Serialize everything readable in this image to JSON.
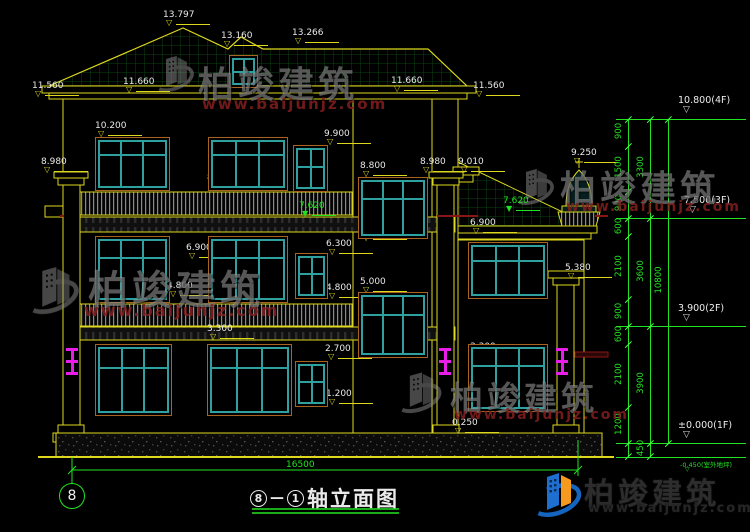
{
  "title": {
    "axis_a": "8",
    "axis_b": "1",
    "text": "轴立面图"
  },
  "axis": {
    "bubble": "8"
  },
  "dims": {
    "overall_width": "16500"
  },
  "watermark": {
    "brand": "柏竣建筑",
    "url": "www.baijunjz.com"
  },
  "colors": {
    "line_yellow": "#ddd81e",
    "dim_green": "#22e322",
    "frame_teal": "#2fa0a0",
    "frame_brown": "#a8641e",
    "lamp_magenta": "#e81ee8",
    "accent_red": "#8a1515"
  },
  "elevation_labels": [
    {
      "t": "13.797",
      "x": 163,
      "y": 10
    },
    {
      "t": "13.160",
      "x": 221,
      "y": 31
    },
    {
      "t": "13.266",
      "x": 292,
      "y": 28
    },
    {
      "t": "11.560",
      "x": 32,
      "y": 81
    },
    {
      "t": "11.660",
      "x": 123,
      "y": 77
    },
    {
      "t": "11.660",
      "x": 391,
      "y": 76
    },
    {
      "t": "11.560",
      "x": 473,
      "y": 81
    },
    {
      "t": "10.200",
      "x": 95,
      "y": 121
    },
    {
      "t": "9.900",
      "x": 324,
      "y": 129
    },
    {
      "t": "8.980",
      "x": 41,
      "y": 157
    },
    {
      "t": "8.800",
      "x": 360,
      "y": 161
    },
    {
      "t": "8.980",
      "x": 420,
      "y": 157
    },
    {
      "t": "9.010",
      "x": 458,
      "y": 157
    },
    {
      "t": "9.250",
      "x": 571,
      "y": 148
    },
    {
      "t": "8.400",
      "x": 95,
      "y": 173
    },
    {
      "t": "8.400",
      "x": 207,
      "y": 173
    },
    {
      "t": "7.620",
      "x": 299,
      "y": 201,
      "g": true
    },
    {
      "t": "7.620",
      "x": 503,
      "y": 196,
      "g": true
    },
    {
      "t": "6.900",
      "x": 186,
      "y": 243
    },
    {
      "t": "6.700",
      "x": 360,
      "y": 225
    },
    {
      "t": "6.300",
      "x": 326,
      "y": 239
    },
    {
      "t": "6.900",
      "x": 470,
      "y": 218
    },
    {
      "t": "5.380",
      "x": 565,
      "y": 263
    },
    {
      "t": "5.000",
      "x": 360,
      "y": 277
    },
    {
      "t": "4.800",
      "x": 167,
      "y": 281
    },
    {
      "t": "4.800",
      "x": 326,
      "y": 283
    },
    {
      "t": "4.800",
      "x": 470,
      "y": 283
    },
    {
      "t": "3.300",
      "x": 207,
      "y": 324
    },
    {
      "t": "2.900",
      "x": 359,
      "y": 339
    },
    {
      "t": "2.700",
      "x": 325,
      "y": 344
    },
    {
      "t": "3.300",
      "x": 470,
      "y": 342
    },
    {
      "t": "1.200",
      "x": 326,
      "y": 389
    },
    {
      "t": "1.200",
      "x": 470,
      "y": 389
    },
    {
      "t": "0.900",
      "x": 207,
      "y": 398
    },
    {
      "t": "0.250",
      "x": 452,
      "y": 418
    }
  ],
  "levels": [
    {
      "text": "10.800(4F)",
      "x": 678,
      "y": 95,
      "ly": 119
    },
    {
      "text": "7.500(3F)",
      "x": 684,
      "y": 195,
      "ly": 218
    },
    {
      "text": "3.900(2F)",
      "x": 678,
      "y": 303,
      "ly": 326
    },
    {
      "text": "±0.000(1F)",
      "x": 678,
      "y": 420,
      "ly": 443
    },
    {
      "text": "-0.450(室外地坪)",
      "x": 680,
      "y": 459,
      "ly": 457,
      "small": true
    }
  ],
  "chains": [
    {
      "x": 628,
      "divs": [
        119,
        146,
        191,
        218,
        236,
        299,
        326,
        344,
        407,
        443,
        456
      ],
      "labels": [
        {
          "v": "900",
          "y": 132
        },
        {
          "v": "1500",
          "y": 168
        },
        {
          "v": "900",
          "y": 204
        },
        {
          "v": "600",
          "y": 227
        },
        {
          "v": "2100",
          "y": 267
        },
        {
          "v": "900",
          "y": 312
        },
        {
          "v": "600",
          "y": 335
        },
        {
          "v": "2100",
          "y": 375
        },
        {
          "v": "1200",
          "y": 425
        }
      ]
    },
    {
      "x": 650,
      "divs": [
        119,
        218,
        326,
        443,
        456
      ],
      "labels": [
        {
          "v": "3300",
          "y": 168
        },
        {
          "v": "3600",
          "y": 272
        },
        {
          "v": "3900",
          "y": 384
        },
        {
          "v": "450",
          "y": 449
        }
      ]
    },
    {
      "x": 668,
      "divs": [
        119,
        443
      ],
      "labels": [
        {
          "v": "10800",
          "y": 281
        }
      ]
    }
  ],
  "windows": [
    {
      "x": 95,
      "y": 137,
      "w": 75,
      "h": 54,
      "mv": [
        0.33,
        0.66
      ],
      "mh": [
        0.3
      ]
    },
    {
      "x": 208,
      "y": 137,
      "w": 80,
      "h": 54,
      "mv": [
        0.33,
        0.66
      ],
      "mh": [
        0.3
      ]
    },
    {
      "x": 293,
      "y": 145,
      "w": 35,
      "h": 47,
      "mv": [
        0.5
      ],
      "mh": [
        0.45
      ]
    },
    {
      "x": 358,
      "y": 177,
      "w": 70,
      "h": 62,
      "mv": [
        0.33,
        0.66
      ],
      "mh": [
        0.32
      ]
    },
    {
      "x": 95,
      "y": 236,
      "w": 75,
      "h": 67,
      "mv": [
        0.33,
        0.66
      ],
      "mh": [
        0.3
      ]
    },
    {
      "x": 208,
      "y": 236,
      "w": 80,
      "h": 67,
      "mv": [
        0.33,
        0.66
      ],
      "mh": [
        0.3
      ]
    },
    {
      "x": 295,
      "y": 253,
      "w": 33,
      "h": 46,
      "mv": [
        0.5
      ],
      "mh": [
        0.45
      ]
    },
    {
      "x": 358,
      "y": 292,
      "w": 70,
      "h": 66,
      "mv": [
        0.33,
        0.66
      ],
      "mh": [
        0.32
      ]
    },
    {
      "x": 95,
      "y": 344,
      "w": 77,
      "h": 72,
      "mv": [
        0.33,
        0.66
      ],
      "mh": [
        0.3
      ]
    },
    {
      "x": 207,
      "y": 344,
      "w": 85,
      "h": 72,
      "mv": [
        0.33,
        0.66
      ],
      "mh": [
        0.3
      ]
    },
    {
      "x": 295,
      "y": 361,
      "w": 33,
      "h": 46,
      "mv": [
        0.5
      ],
      "mh": [
        0.45
      ]
    },
    {
      "x": 468,
      "y": 242,
      "w": 80,
      "h": 57,
      "mv": [
        0.33,
        0.66
      ],
      "mh": [
        0.3
      ]
    },
    {
      "x": 468,
      "y": 344,
      "w": 80,
      "h": 68,
      "mv": [
        0.33,
        0.66
      ],
      "mh": [
        0.3
      ]
    },
    {
      "x": 229,
      "y": 55,
      "w": 29,
      "h": 33,
      "mv": [
        0.5
      ],
      "mh": [
        0.5
      ]
    }
  ],
  "lamps": [
    {
      "x": 66,
      "y": 348
    },
    {
      "x": 439,
      "y": 348
    },
    {
      "x": 556,
      "y": 348
    }
  ]
}
